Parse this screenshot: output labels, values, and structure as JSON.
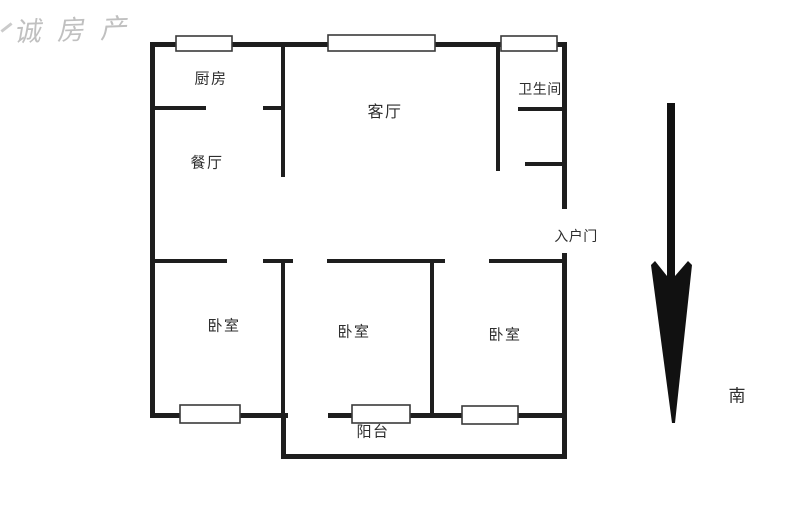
{
  "watermark": {
    "text": "诚房产"
  },
  "floorplan": {
    "rooms": [
      {
        "id": "kitchen",
        "label": "厨房"
      },
      {
        "id": "living",
        "label": "客厅"
      },
      {
        "id": "bathroom",
        "label": "卫生间"
      },
      {
        "id": "dining",
        "label": "餐厅"
      },
      {
        "id": "bedroom-1",
        "label": "卧室"
      },
      {
        "id": "bedroom-2",
        "label": "卧室"
      },
      {
        "id": "bedroom-3",
        "label": "卧室"
      },
      {
        "id": "balcony",
        "label": "阳台"
      }
    ],
    "entrance_label": "入户门",
    "compass": {
      "label": "南",
      "direction": "south"
    }
  },
  "colors": {
    "background": "#ffffff",
    "wall": "#1e1e1e",
    "window_border": "#3a3a3a",
    "text": "#2e2e2e",
    "watermark": "#8c8c8c"
  }
}
